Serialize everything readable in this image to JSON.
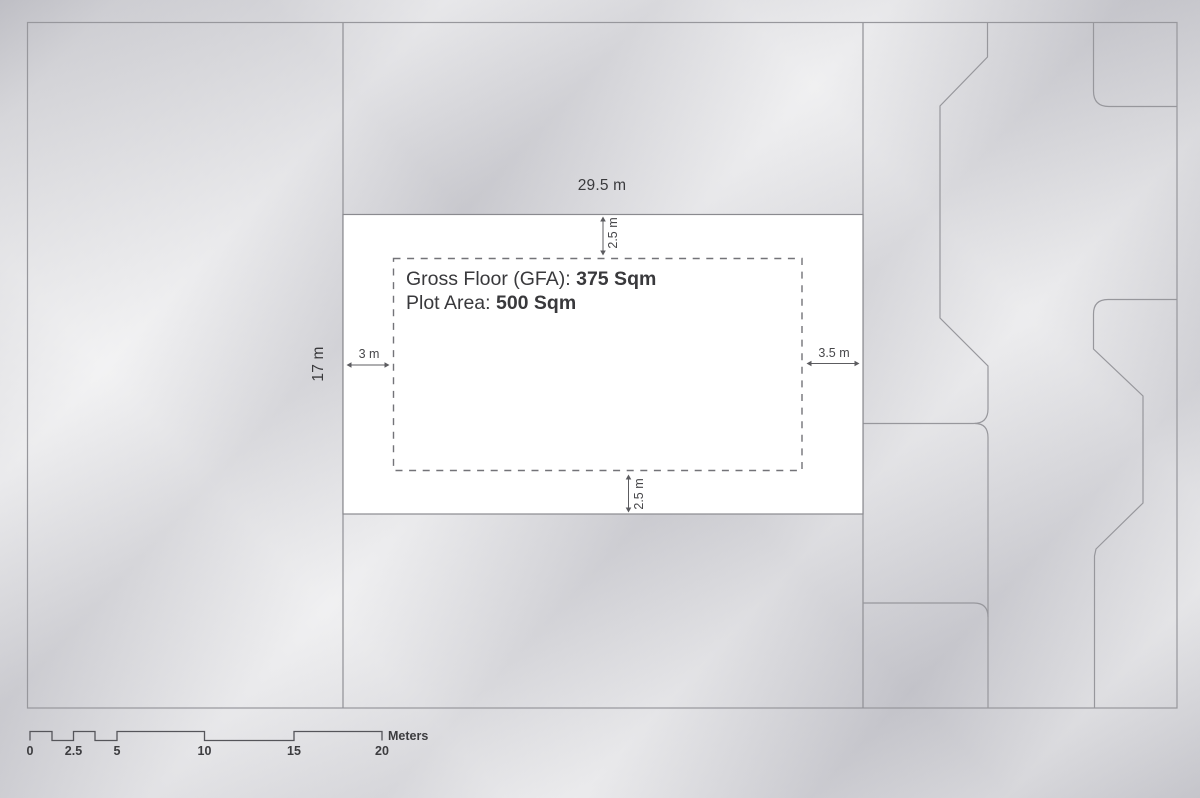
{
  "plan": {
    "info_box": {
      "line1_label": "Gross Floor (GFA): ",
      "line1_value": "375 Sqm",
      "line2_label": "Plot Area: ",
      "line2_value": "500 Sqm"
    },
    "dimensions": {
      "plot_width": "29.5 m",
      "plot_height": "17 m",
      "setback_top": "2.5 m",
      "setback_bottom": "2.5 m",
      "setback_left": "3 m",
      "setback_right": "3.5 m"
    },
    "scale_bar": {
      "ticks": [
        "0",
        "2.5",
        "5",
        "10",
        "15",
        "20"
      ],
      "unit_label": "Meters"
    },
    "colors": {
      "parcel_line": "#97979c",
      "plot_fill": "#ffffff",
      "plot_stroke": "#8a8a8f",
      "dashed_outline": "#737378",
      "arrow": "#5c5c60",
      "text": "#3a3a3d"
    }
  }
}
